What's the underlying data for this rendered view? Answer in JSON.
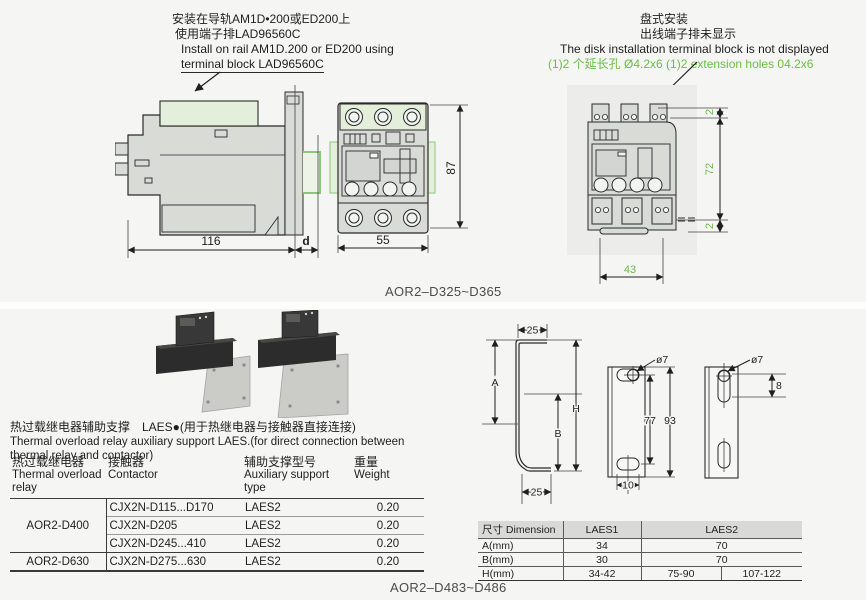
{
  "top": {
    "left_note": {
      "cn1": "安装在导轨AM1D•200或ED200上",
      "cn2": "使用端子排LAD96560C",
      "en1": "Install on rail AM1D.200 or ED200 using",
      "en2": "terminal block LAD96560C"
    },
    "right_note": {
      "cn1": "盘式安装",
      "cn2": "出线端子排未显示",
      "en1": "The disk installation terminal block is not displayed",
      "green": "(1)2 个延长孔 Ø4.2x6 (1)2 extension holes 04.2x6"
    },
    "dims": {
      "w116": "116",
      "d": "d",
      "w55": "55",
      "h87": "87",
      "t2a": "2",
      "h72": "72",
      "t2b": "2",
      "w43": "43"
    },
    "model_label": "AOR2–D325~D365"
  },
  "bottom": {
    "title_cn": "热过载继电器辅助支撑　LAES●(用于热继电器与接触器直接连接)",
    "title_en1": "Thermal overload relay auxiliary support LAES.(for direct connection between",
    "title_en2": "thermal relay and contactor)",
    "support_table": {
      "col1_cn": "热过载继电器",
      "col1_en": "Thermal overload relay",
      "col2_cn": "接触器",
      "col2_en": "Contactor",
      "col3_cn": "辅助支撑型号",
      "col3_en": "Auxiliary support type",
      "col4_cn": "重量",
      "col4_en": "Weight",
      "rows": [
        {
          "relay": "AOR2-D400",
          "contactor": "CJX2N-D115...D170",
          "support": "LAES2",
          "weight": "0.20"
        },
        {
          "contactor": "CJX2N-D205",
          "support": "LAES2",
          "weight": "0.20"
        },
        {
          "contactor": "CJX2N-D245...410",
          "support": "LAES2",
          "weight": "0.20"
        },
        {
          "relay": "AOR2-D630",
          "contactor": "CJX2N-D275...630",
          "support": "LAES2",
          "weight": "0.20"
        }
      ]
    },
    "dims": {
      "top25": "25",
      "A": "A",
      "B": "B",
      "H": "H",
      "bottom25": "25",
      "dia7a": "ø7",
      "h77": "77",
      "h93": "93",
      "w10": "10",
      "dia7b": "ø7",
      "s8": "8"
    },
    "dim_table": {
      "h_dim": "尺寸 Dimension",
      "h_laes1": "LAES1",
      "h_laes2": "LAES2",
      "rows": [
        {
          "label": "A(mm)",
          "v1": "34",
          "v2": "70"
        },
        {
          "label": "B(mm)",
          "v1": "30",
          "v2": "70"
        },
        {
          "label": "H(mm)",
          "v1": "34-42",
          "v2a": "75-90",
          "v2b": "107-122"
        }
      ]
    },
    "model_label": "AOR2–D483~D486"
  },
  "colors": {
    "accent_green": "#68bf45",
    "drawing_gray": "#d9dbd7",
    "green_fill": "#e4efdb"
  }
}
